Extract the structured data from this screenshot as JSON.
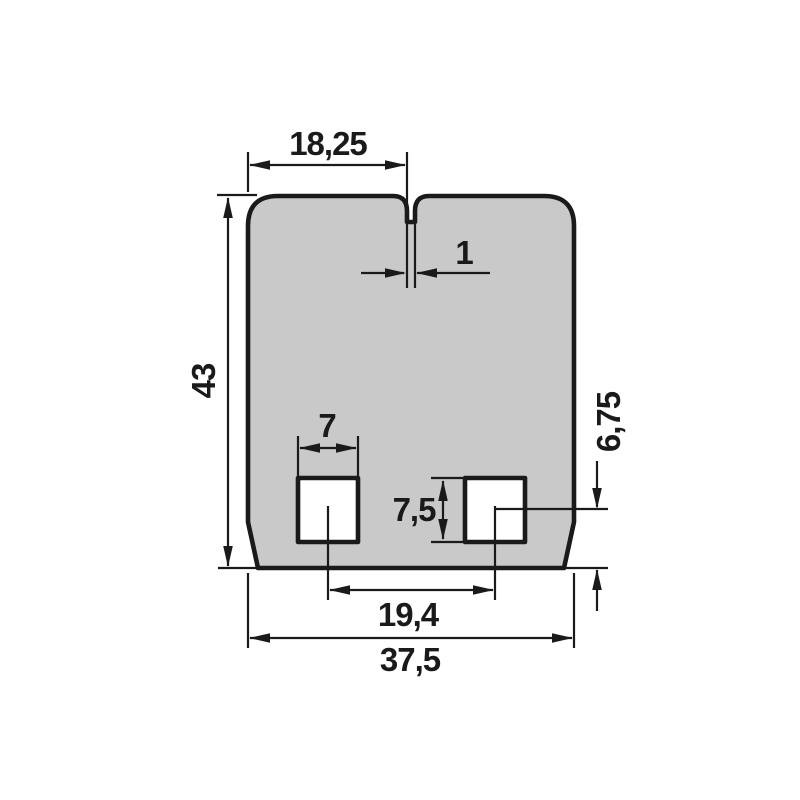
{
  "drawing": {
    "colors": {
      "part_fill": "#c9c9c9",
      "cutout_fill": "#ffffff",
      "line": "#1a1a1a",
      "background": "#ffffff"
    },
    "dimensions": {
      "top_width": "18,25",
      "notch_width": "1",
      "height": "43",
      "cutout_width": "7",
      "cutout_height": "7,5",
      "center_to_bottom": "6,75",
      "center_spacing": "19,4",
      "total_width": "37,5"
    }
  }
}
